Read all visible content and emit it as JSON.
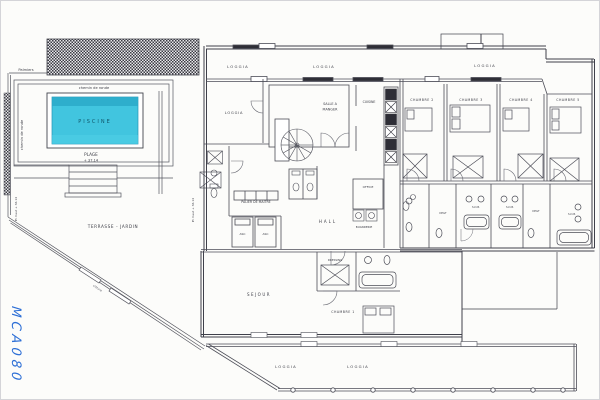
{
  "drawing": {
    "handwritten_mark": "MCA080",
    "colors": {
      "pool_fill": "#41c5df",
      "pool_shade": "#2ba9c9",
      "ink": "#4c4d57",
      "handwriting": "#2d6fd6"
    },
    "labels": {
      "palmiers": "Palmiers",
      "chemin_top": "chemin de ronde",
      "chemin_side": "chemin de ronde",
      "piscine": "PISCINE",
      "plage": "PLAGE",
      "plage_level": "+ 37.14",
      "pl_left": "Pl. haut + 36.14",
      "pl_right": "Pl. haut + 36.14",
      "terrasse": "TERRASSE - JARDIN",
      "cloture": "clôture",
      "loggia_a": "LOGGIA",
      "loggia_b": "LOGGIA",
      "loggia_room": "LOGGIA",
      "loggia_right": "LOGGIA",
      "loggia_c": "LOGGIA",
      "loggia_d": "LOGGIA",
      "salle_1": "SALLE A",
      "salle_2": "MANGER",
      "cuisine": "CUISINE",
      "office": "OFFICE",
      "buanderie": "BUANDERIE",
      "palier": "PALIER DE MAITRE",
      "asc1": "ASC",
      "asc2": "ASC",
      "hall": "HALL",
      "sejour": "SEJOUR",
      "dressing": "DRESSING",
      "ch1": "CHAMBRE 1",
      "ch2": "CHAMBRE 2",
      "ch3": "CHAMBRE 3",
      "ch4": "CHAMBRE 4",
      "ch5": "CHAMBRE 5",
      "sdb1": "S.D.B.",
      "sdb2": "S.D.B.",
      "sdb3": "S.D.B.",
      "degt1": "DEGT",
      "degt2": "DEGT"
    }
  }
}
